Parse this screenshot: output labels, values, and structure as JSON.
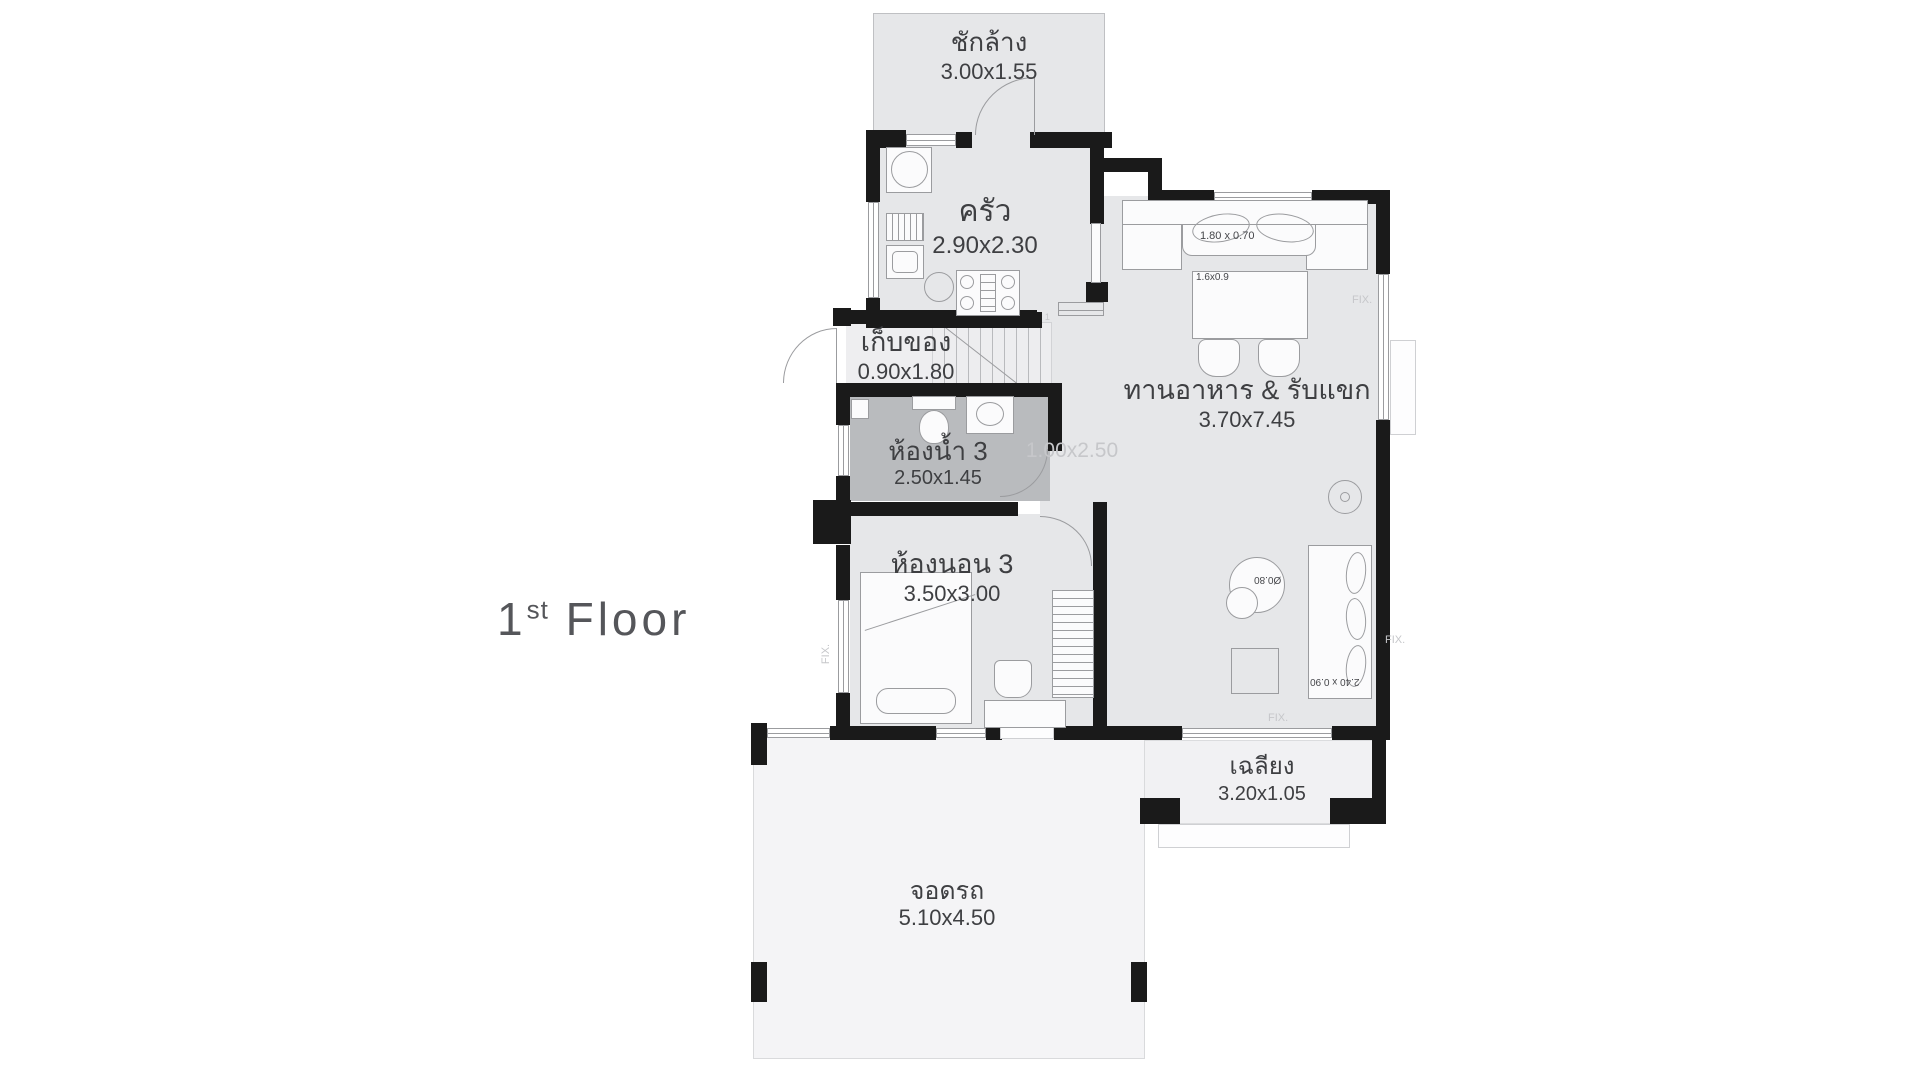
{
  "title": {
    "floor_number": "1",
    "floor_sup": "st",
    "floor_word": "Floor"
  },
  "rooms": {
    "laundry": {
      "name": "ชักล้าง",
      "dims": "3.00x1.55"
    },
    "kitchen": {
      "name": "ครัว",
      "dims": "2.90x2.30"
    },
    "storage": {
      "name": "เก็บของ",
      "dims": "0.90x1.80"
    },
    "bathroom3": {
      "name": "ห้องน้ำ 3",
      "dims": "2.50x1.45"
    },
    "bedroom3": {
      "name": "ห้องนอน 3",
      "dims": "3.50x3.00"
    },
    "living": {
      "name": "ทานอาหาร & รับแขก",
      "dims": "3.70x7.45"
    },
    "porch": {
      "name": "เฉลียง",
      "dims": "3.20x1.05"
    },
    "carport": {
      "name": "จอดรถ",
      "dims": "5.10x4.50"
    }
  },
  "annotations": {
    "stair_hall_dims": "1.00x2.50",
    "bench_dims": "1.80 x 0.70",
    "dining_table_dims": "1.6x0.9",
    "sofa_dims": "2.40 x 0.90",
    "round_table_dims": "Ø0.80",
    "fix_label": "FIX.",
    "stair_numbers": [
      "9",
      "8",
      "7",
      "6",
      "5",
      "4",
      "3",
      "2",
      "1"
    ]
  },
  "colors": {
    "wall": "#1a1a1a",
    "room_fill": "#e6e7e9",
    "bath_fill": "#b9bbbe",
    "storage_fill": "#eeeef0",
    "light_fill": "#f4f4f6",
    "outline": "#9b9c9f",
    "label_text": "#3e3f42",
    "faint_text": "#c6c7ca"
  }
}
